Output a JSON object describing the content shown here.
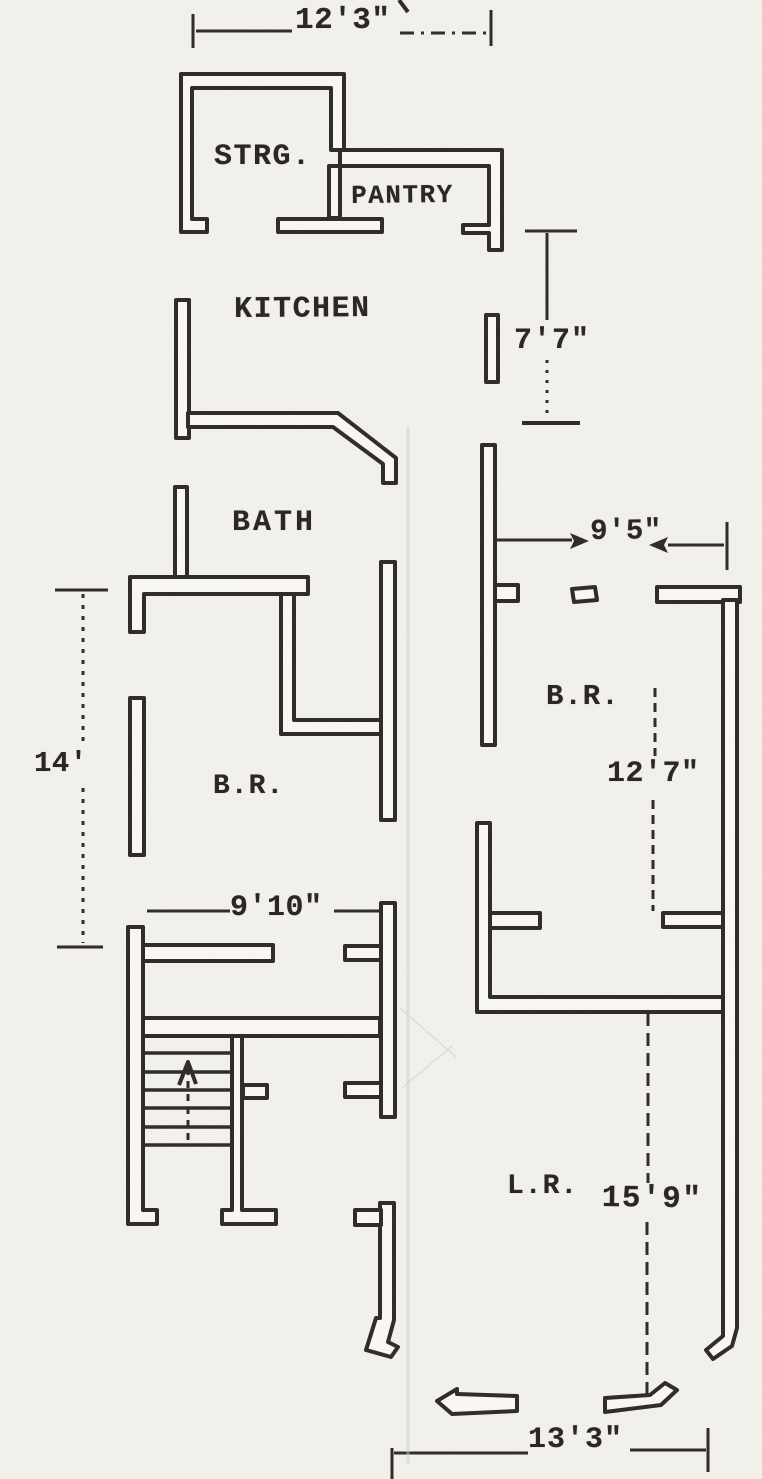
{
  "document": {
    "kind": "scanned floor plan drawing",
    "floor_note": "single-story apartment plan, hand drafted, typewriter labels"
  },
  "palette": {
    "paper": "#f4f2ed",
    "wall_fill": "#faf9f5",
    "ink": "#2e2a26",
    "artifact": "#c7ccd2",
    "artifact2": "#a9b0b6"
  },
  "rooms": [
    {
      "key": "storage",
      "label": "STRG."
    },
    {
      "key": "pantry",
      "label": "PANTRY"
    },
    {
      "key": "kitchen",
      "label": "KITCHEN"
    },
    {
      "key": "bath",
      "label": "BATH"
    },
    {
      "key": "bedroom_left",
      "label": "B.R."
    },
    {
      "key": "bedroom_right",
      "label": "B.R."
    },
    {
      "key": "living_room",
      "label": "L.R."
    }
  ],
  "dimensions": [
    {
      "key": "top_width",
      "label": "12'3\""
    },
    {
      "key": "kitchen_height",
      "label": "7'7\""
    },
    {
      "key": "bedroom_right_width",
      "label": "9'5\""
    },
    {
      "key": "bedroom_left_height",
      "label": "14'"
    },
    {
      "key": "hall_width",
      "label": "9'10\""
    },
    {
      "key": "bedroom_right_height",
      "label": "12'7\""
    },
    {
      "key": "living_room_height",
      "label": "15'9\""
    },
    {
      "key": "bottom_width",
      "label": "13'3\""
    }
  ],
  "plan": {
    "canvas": {
      "width": 762,
      "height": 1479
    },
    "strokes": [
      {
        "n": "wall-strg-outline",
        "k": "wall",
        "d": "M181,74 L344,74 L344,150 L331,150 L331,88 L192,88 L192,219 L207,219 L207,232 L181,232 Z"
      },
      {
        "n": "wall-pantry-outline",
        "k": "wall",
        "d": "M344,150 L502,150 L502,250 L489,250 L489,233 L463,233 L463,225 L489,225 L489,166 L340,166 L340,150 Z"
      },
      {
        "n": "wall-strg-pantry-divider",
        "k": "wall",
        "d": "M329,166 L340,166 L340,218 L329,218 Z"
      },
      {
        "n": "wall-pantry-south",
        "k": "wall",
        "d": "M278,219 L382,219 L382,232 L278,232 Z"
      },
      {
        "n": "wall-kitchen-west",
        "k": "wall",
        "d": "M176,300 L189,300 L189,438 L176,438 Z"
      },
      {
        "n": "wall-kitchen-south-diagonal",
        "k": "wall",
        "d": "M188,413 L338,413 L396,458 L396,483 L383,483 L383,464 L333,427 L188,427 Z"
      },
      {
        "n": "wall-kitchen-east-stub",
        "k": "wall",
        "d": "M486,315 L498,315 L498,382 L486,382 Z"
      },
      {
        "n": "wall-bath-north-stub",
        "k": "wall",
        "d": "M175,487 L187,487 L187,577 L175,577 Z"
      },
      {
        "n": "wall-bath-south",
        "k": "wall",
        "d": "M130,577 L308,577 L308,594 L144,594 L144,632 L130,632 Z"
      },
      {
        "n": "wall-bath-closet",
        "k": "wall",
        "d": "M281,594 L294,594 L294,720 L384,720 L384,734 L281,734 Z"
      },
      {
        "n": "wall-bedroom-left-west",
        "k": "wall",
        "d": "M130,698 L144,698 L144,855 L130,855 Z"
      },
      {
        "n": "wall-central-upper",
        "k": "wall",
        "d": "M381,562 L395,562 L395,820 L381,820 Z"
      },
      {
        "n": "wall-central-middle",
        "k": "wall",
        "d": "M381,903 L395,903 L395,1117 L381,1117 Z"
      },
      {
        "n": "wall-central-lower-boot",
        "k": "wall",
        "d": "M380,1203 L394,1203 L394,1320 L388,1342 L398,1347 L391,1357 L366,1350 L376,1318 L380,1318 Z"
      },
      {
        "n": "wall-central-lower-stub",
        "k": "wall",
        "d": "M355,1210 L381,1210 L381,1225 L355,1225 Z"
      },
      {
        "n": "wall-hall-west",
        "k": "wall",
        "d": "M128,927 L143,927 L143,1210 L157,1210 L157,1224 L128,1224 Z"
      },
      {
        "n": "wall-hall-north",
        "k": "wall",
        "d": "M143,945 L273,945 L273,961 L143,961 Z"
      },
      {
        "n": "wall-hall-north-stub",
        "k": "wall",
        "d": "M345,946 L381,946 L381,960 L345,960 Z"
      },
      {
        "n": "wall-stair-north",
        "k": "wall",
        "d": "M143,1018 L380,1018 L380,1036 L143,1036 Z"
      },
      {
        "n": "wall-stair-divider",
        "k": "wall",
        "d": "M232,1036 L242,1036 L242,1210 L276,1210 L276,1224 L222,1224 L222,1210 L232,1210 Z"
      },
      {
        "n": "wall-stair-divider-stub",
        "k": "wall",
        "d": "M243,1085 L267,1085 L267,1098 L243,1098 Z"
      },
      {
        "n": "wall-hall-south-stub",
        "k": "wall",
        "d": "M345,1083 L381,1083 L381,1097 L345,1097 Z"
      },
      {
        "n": "wall-bedroom-right-west-upper",
        "k": "wall",
        "d": "M482,445 L495,445 L495,745 L482,745 Z"
      },
      {
        "n": "wall-bedroom-right-west-stub",
        "k": "wall",
        "d": "M495,585 L518,585 L518,601 L495,601 Z"
      },
      {
        "n": "wall-door-stub",
        "k": "wall",
        "d": "M572,589 L595,587 L597,600 L574,602 Z"
      },
      {
        "n": "wall-bedroom-right-north",
        "k": "wall",
        "d": "M657,587 L740,587 L740,602 L657,602 Z"
      },
      {
        "n": "wall-east-long",
        "k": "wall",
        "d": "M723,600 L737,600 L737,1328 L732,1346 L713,1359 L706,1350 L723,1336 Z"
      },
      {
        "n": "wall-bedroom-right-south",
        "k": "wall",
        "d": "M477,823 L490,823 L490,997 L723,997 L723,1012 L477,1012 Z"
      },
      {
        "n": "wall-bedroom-right-south-stub",
        "k": "wall",
        "d": "M490,913 L540,913 L540,928 L490,928 Z"
      },
      {
        "n": "wall-east-stub",
        "k": "wall",
        "d": "M663,913 L723,913 L723,927 L663,927 Z"
      },
      {
        "n": "wall-door-arrow-left",
        "k": "wall",
        "d": "M517,1396 L457,1394 L457,1389 L437,1401 L452,1414 L517,1411 Z"
      },
      {
        "n": "wall-door-arrow-right",
        "k": "wall",
        "d": "M605,1398 L650,1395 L665,1383 L677,1390 L661,1405 L605,1412 Z"
      },
      {
        "n": "dim-12-3-left-tick",
        "k": "line",
        "d": "M193,14 L193,48"
      },
      {
        "n": "dim-12-3-line-left",
        "k": "line",
        "d": "M196,31 L292,31"
      },
      {
        "n": "dim-12-3-line-right",
        "k": "line",
        "d": "M400,33 L486,33",
        "dash": "14 7 3 7"
      },
      {
        "n": "dim-12-3-right-tick",
        "k": "line",
        "d": "M491,10 L491,46"
      },
      {
        "n": "dim-7-7-top-tick",
        "k": "line",
        "d": "M525,231 L577,231"
      },
      {
        "n": "dim-7-7-line-upper",
        "k": "line",
        "d": "M547,233 L547,320"
      },
      {
        "n": "dim-7-7-line-lower",
        "k": "line",
        "d": "M547,360 L547,418",
        "dash": "3 7"
      },
      {
        "n": "dim-7-7-bottom-tick",
        "k": "line",
        "d": "M522,423 L580,423",
        "w": 4
      },
      {
        "n": "dim-9-5-line-left",
        "k": "line",
        "d": "M497,540 L572,540"
      },
      {
        "n": "dim-9-5-line-right",
        "k": "line",
        "d": "M668,545 L724,545"
      },
      {
        "n": "dim-9-5-right-tick",
        "k": "line",
        "d": "M727,522 L727,570"
      },
      {
        "n": "dim-14-top-tick",
        "k": "line",
        "d": "M55,590 L108,590"
      },
      {
        "n": "dim-14-line-upper",
        "k": "line",
        "d": "M83,594 L83,744",
        "dash": "4 7"
      },
      {
        "n": "dim-14-line-lower",
        "k": "line",
        "d": "M83,788 L83,943",
        "dash": "4 7"
      },
      {
        "n": "dim-14-bottom-tick",
        "k": "line",
        "d": "M57,947 L103,947"
      },
      {
        "n": "dim-9-10-line-left",
        "k": "line",
        "d": "M147,911 L230,911"
      },
      {
        "n": "dim-9-10-line-right",
        "k": "line",
        "d": "M334,911 L380,911"
      },
      {
        "n": "dim-12-7-line-upper",
        "k": "line",
        "d": "M655,688 L655,756",
        "dash": "9 6"
      },
      {
        "n": "dim-12-7-line-lower",
        "k": "line",
        "d": "M653,800 L653,911",
        "dash": "9 6"
      },
      {
        "n": "dim-15-9-line-upper",
        "k": "line",
        "d": "M648,1013 L648,1183",
        "dash": "13 7"
      },
      {
        "n": "dim-15-9-line-lower",
        "k": "line",
        "d": "M647,1222 L647,1394",
        "dash": "13 7"
      },
      {
        "n": "dim-13-3-left-tick",
        "k": "line",
        "d": "M392,1448 L392,1479"
      },
      {
        "n": "dim-13-3-line-left",
        "k": "line",
        "d": "M394,1453 L528,1453"
      },
      {
        "n": "dim-13-3-line-right",
        "k": "line",
        "d": "M630,1450 L706,1450"
      },
      {
        "n": "dim-13-3-right-tick",
        "k": "line",
        "d": "M708,1428 L708,1472"
      },
      {
        "n": "stair-tread",
        "k": "line",
        "d": "M144,1053 L232,1053",
        "w": 3.5
      },
      {
        "n": "stair-tread",
        "k": "line",
        "d": "M144,1072 L232,1072",
        "w": 3.5
      },
      {
        "n": "stair-tread",
        "k": "line",
        "d": "M144,1090 L232,1090",
        "w": 3.5
      },
      {
        "n": "stair-tread",
        "k": "line",
        "d": "M144,1108 L232,1108",
        "w": 3.5
      },
      {
        "n": "stair-tread",
        "k": "line",
        "d": "M144,1127 L232,1127",
        "w": 3.5
      },
      {
        "n": "stair-tread",
        "k": "line",
        "d": "M144,1145 L232,1145",
        "w": 3.5
      },
      {
        "n": "stair-up-arrow-head",
        "k": "line",
        "d": "M179,1085 L188,1062 L196,1084",
        "w": 4
      },
      {
        "n": "stair-up-arrow-stem",
        "k": "line",
        "d": "M188,1068 L188,1145",
        "dash": "7 6"
      },
      {
        "n": "dim-9-5-arrowhead-right",
        "k": "solid",
        "d": "M589,541 L570,533 L574,541 L570,549 Z"
      },
      {
        "n": "dim-9-5-arrowhead-left",
        "k": "solid",
        "d": "M649,545 L668,537 L664,545 L668,553 Z"
      },
      {
        "n": "page-edge-mark",
        "k": "line",
        "d": "M399,0 L408,12",
        "w": 4
      },
      {
        "n": "scan-artifact-line",
        "k": "faint",
        "d": "M408,428 L408,1462",
        "w": 3,
        "o": 0.5
      },
      {
        "n": "scan-artifact-scratch",
        "k": "faint",
        "d": "M400,1008 L456,1057",
        "w": 1.5,
        "o": 0.5
      },
      {
        "n": "scan-artifact-scratch",
        "k": "faint",
        "d": "M402,1088 L452,1046",
        "w": 1.5,
        "o": 0.5
      }
    ]
  }
}
